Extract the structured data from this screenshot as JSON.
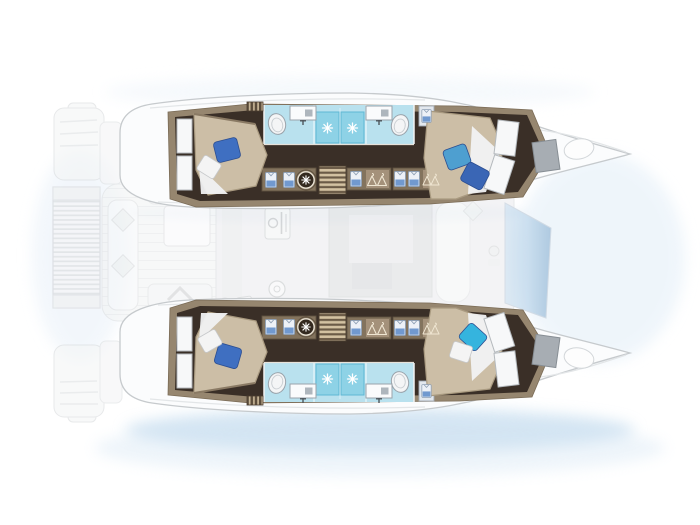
{
  "meta": {
    "diagram_type": "catamaran-deck-plan",
    "description": "Top-down layout plan of a 4-cabin sailing catamaran: two hulls each with forward and aft double cabins and twin en-suite bathrooms, faded central salon/cockpit deck, aft slatted platform, pointed bows to the right",
    "text_on_image": ""
  },
  "colors": {
    "background": "#ffffff",
    "hullDeck": "#fbfcfd",
    "hullStroke": "#c6cacd",
    "floor": "#3a2f27",
    "wall": "#96866f",
    "cabinet": "#83735d",
    "cabinetEdge": "#5f5240",
    "bathroomFloor": "#b9e1ee",
    "showerTile": "#8ed2e6",
    "showerEdge": "#5fb8d4",
    "bed": "#ccbea6",
    "bedEdge": "#a99a80",
    "sheetWhite": "#f2f3f4",
    "pillowRoyal": "#3f6fc1",
    "pillowSky": "#4e9fd0",
    "pillowNavy": "#3a66b5",
    "pillowCyan": "#35b4de",
    "stepTread": "#d3c2a2",
    "stepBase": "#6b5b47",
    "fadedDeck": "#f1f2f3",
    "fadedStroke": "#d9dbdd",
    "glassTop": "#aecde6",
    "glassBottom": "#7fa8cd",
    "waterWash": "#b5d3ea",
    "hatchGray": "#a7adb3"
  },
  "vessel": {
    "orientation": {
      "bow": "right",
      "stern": "left"
    },
    "hulls": [
      {
        "name": "port-hull",
        "position": "top",
        "cabins": [
          {
            "name": "aft-cabin",
            "bed": "double",
            "pillows": [
              "royal-blue",
              "white"
            ]
          },
          {
            "name": "forward-cabin",
            "bed": "double",
            "pillows": [
              "sky-blue",
              "navy-blue"
            ]
          }
        ],
        "bathrooms": [
          {
            "name": "aft-head",
            "fixtures": [
              "toilet",
              "sink-vanity",
              "shower"
            ]
          },
          {
            "name": "forward-head",
            "fixtures": [
              "sink-vanity",
              "toilet",
              "shower"
            ]
          }
        ],
        "corridor": [
          "wardrobe-folded-shirts",
          "washing-machine",
          "companionway-steps",
          "hanging-locker",
          "hanging-locker"
        ]
      },
      {
        "name": "starboard-hull",
        "position": "bottom",
        "cabins": [
          {
            "name": "aft-cabin",
            "bed": "double",
            "pillows": [
              "white",
              "royal-blue"
            ]
          },
          {
            "name": "forward-cabin",
            "bed": "double",
            "pillows": [
              "cyan",
              "white"
            ]
          }
        ],
        "bathrooms": [
          {
            "name": "aft-head",
            "fixtures": [
              "toilet",
              "sink-vanity",
              "shower"
            ]
          },
          {
            "name": "forward-head",
            "fixtures": [
              "sink-vanity",
              "toilet",
              "shower"
            ]
          }
        ],
        "corridor": [
          "wardrobe-folded-shirts",
          "washing-machine",
          "companionway-steps",
          "hanging-locker",
          "hanging-locker"
        ]
      }
    ],
    "bridgedeck": {
      "salon": [
        "galley-counter",
        "stove",
        "sink",
        "dinette-table",
        "sofa",
        "forward-windshield"
      ],
      "cockpit": [
        "side-bench",
        "cushions",
        "cockpit-table",
        "aft-bench",
        "stairs-chevron"
      ],
      "aft": [
        "slatted-swim-platform",
        "port-transom-steps",
        "starboard-transom-steps"
      ],
      "foredeck": [
        "deck-hatch",
        "sun-pad"
      ]
    }
  },
  "icon_legend": {
    "shower-rose": "white starburst on blue tile",
    "washing-machine": "dark porthole circle with white spokes",
    "wardrobe": "folded shirt glyphs",
    "hanging-locker": "clothes hanger glyphs"
  }
}
